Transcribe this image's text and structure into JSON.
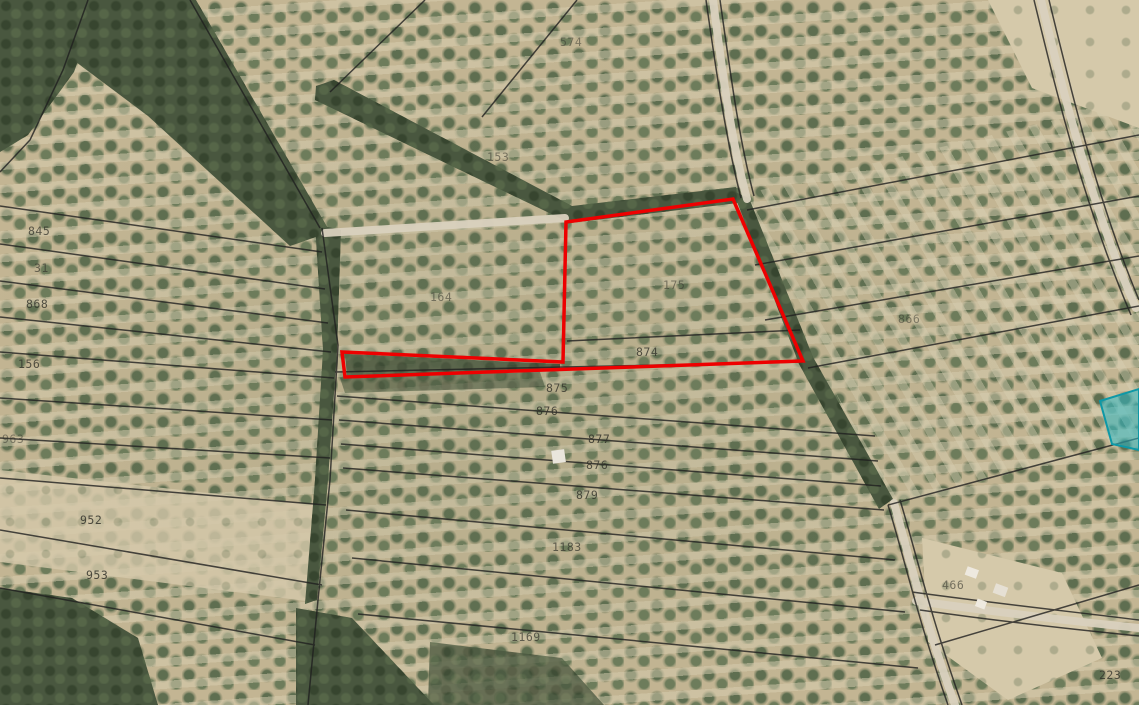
{
  "map": {
    "type": "aerial-cadastral-map",
    "colors": {
      "soil_tan": "#c7b998",
      "olive_tree_green": "#5e6e50",
      "woodland_dark_green": "#49573f",
      "boundary_black": "#1f1f1f",
      "road_light": "#d9d1be",
      "highlight_red": "#ee0000",
      "overlay_cyan_fill": "#2fb9c6",
      "overlay_cyan_stroke": "#0e98a6",
      "label_color": "#33332b"
    }
  },
  "overlays": {
    "red_parcel": {
      "points": "342,352 563,362 566,222 733,199 803,361 345,377",
      "color": "#ee0000",
      "stroke_width": 3.5
    },
    "cyan_parcel": {
      "points": "1100,401 1139,389 1139,450 1112,444",
      "fill": "#2fb9c6",
      "stroke": "#0e98a6",
      "fill_opacity": 0.55
    }
  },
  "labels": [
    {
      "text": "845",
      "x": 28,
      "y": 225,
      "o": 0.75
    },
    {
      "text": "31",
      "x": 34,
      "y": 262,
      "o": 0.65
    },
    {
      "text": "868",
      "x": 26,
      "y": 298,
      "o": 0.8
    },
    {
      "text": "156",
      "x": 18,
      "y": 358,
      "o": 0.8
    },
    {
      "text": "963",
      "x": 2,
      "y": 433,
      "o": 0.5
    },
    {
      "text": "952",
      "x": 80,
      "y": 514,
      "o": 0.85
    },
    {
      "text": "953",
      "x": 86,
      "y": 569,
      "o": 0.85
    },
    {
      "text": "153",
      "x": 487,
      "y": 151,
      "o": 0.55
    },
    {
      "text": "574",
      "x": 560,
      "y": 36,
      "o": 0.5
    },
    {
      "text": "164",
      "x": 430,
      "y": 291,
      "o": 0.55
    },
    {
      "text": "175",
      "x": 663,
      "y": 279,
      "o": 0.55
    },
    {
      "text": "874",
      "x": 636,
      "y": 346,
      "o": 0.8
    },
    {
      "text": "875",
      "x": 546,
      "y": 382,
      "o": 0.8
    },
    {
      "text": "876",
      "x": 536,
      "y": 405,
      "o": 0.85
    },
    {
      "text": "877",
      "x": 588,
      "y": 433,
      "o": 0.85
    },
    {
      "text": "876",
      "x": 586,
      "y": 459,
      "o": 0.8
    },
    {
      "text": "879",
      "x": 576,
      "y": 489,
      "o": 0.8
    },
    {
      "text": "1183",
      "x": 552,
      "y": 541,
      "o": 0.7
    },
    {
      "text": "1169",
      "x": 511,
      "y": 631,
      "o": 0.7
    },
    {
      "text": "866",
      "x": 898,
      "y": 313,
      "o": 0.5
    },
    {
      "text": "466",
      "x": 942,
      "y": 579,
      "o": 0.6
    },
    {
      "text": "223",
      "x": 1099,
      "y": 669,
      "o": 0.8
    }
  ]
}
